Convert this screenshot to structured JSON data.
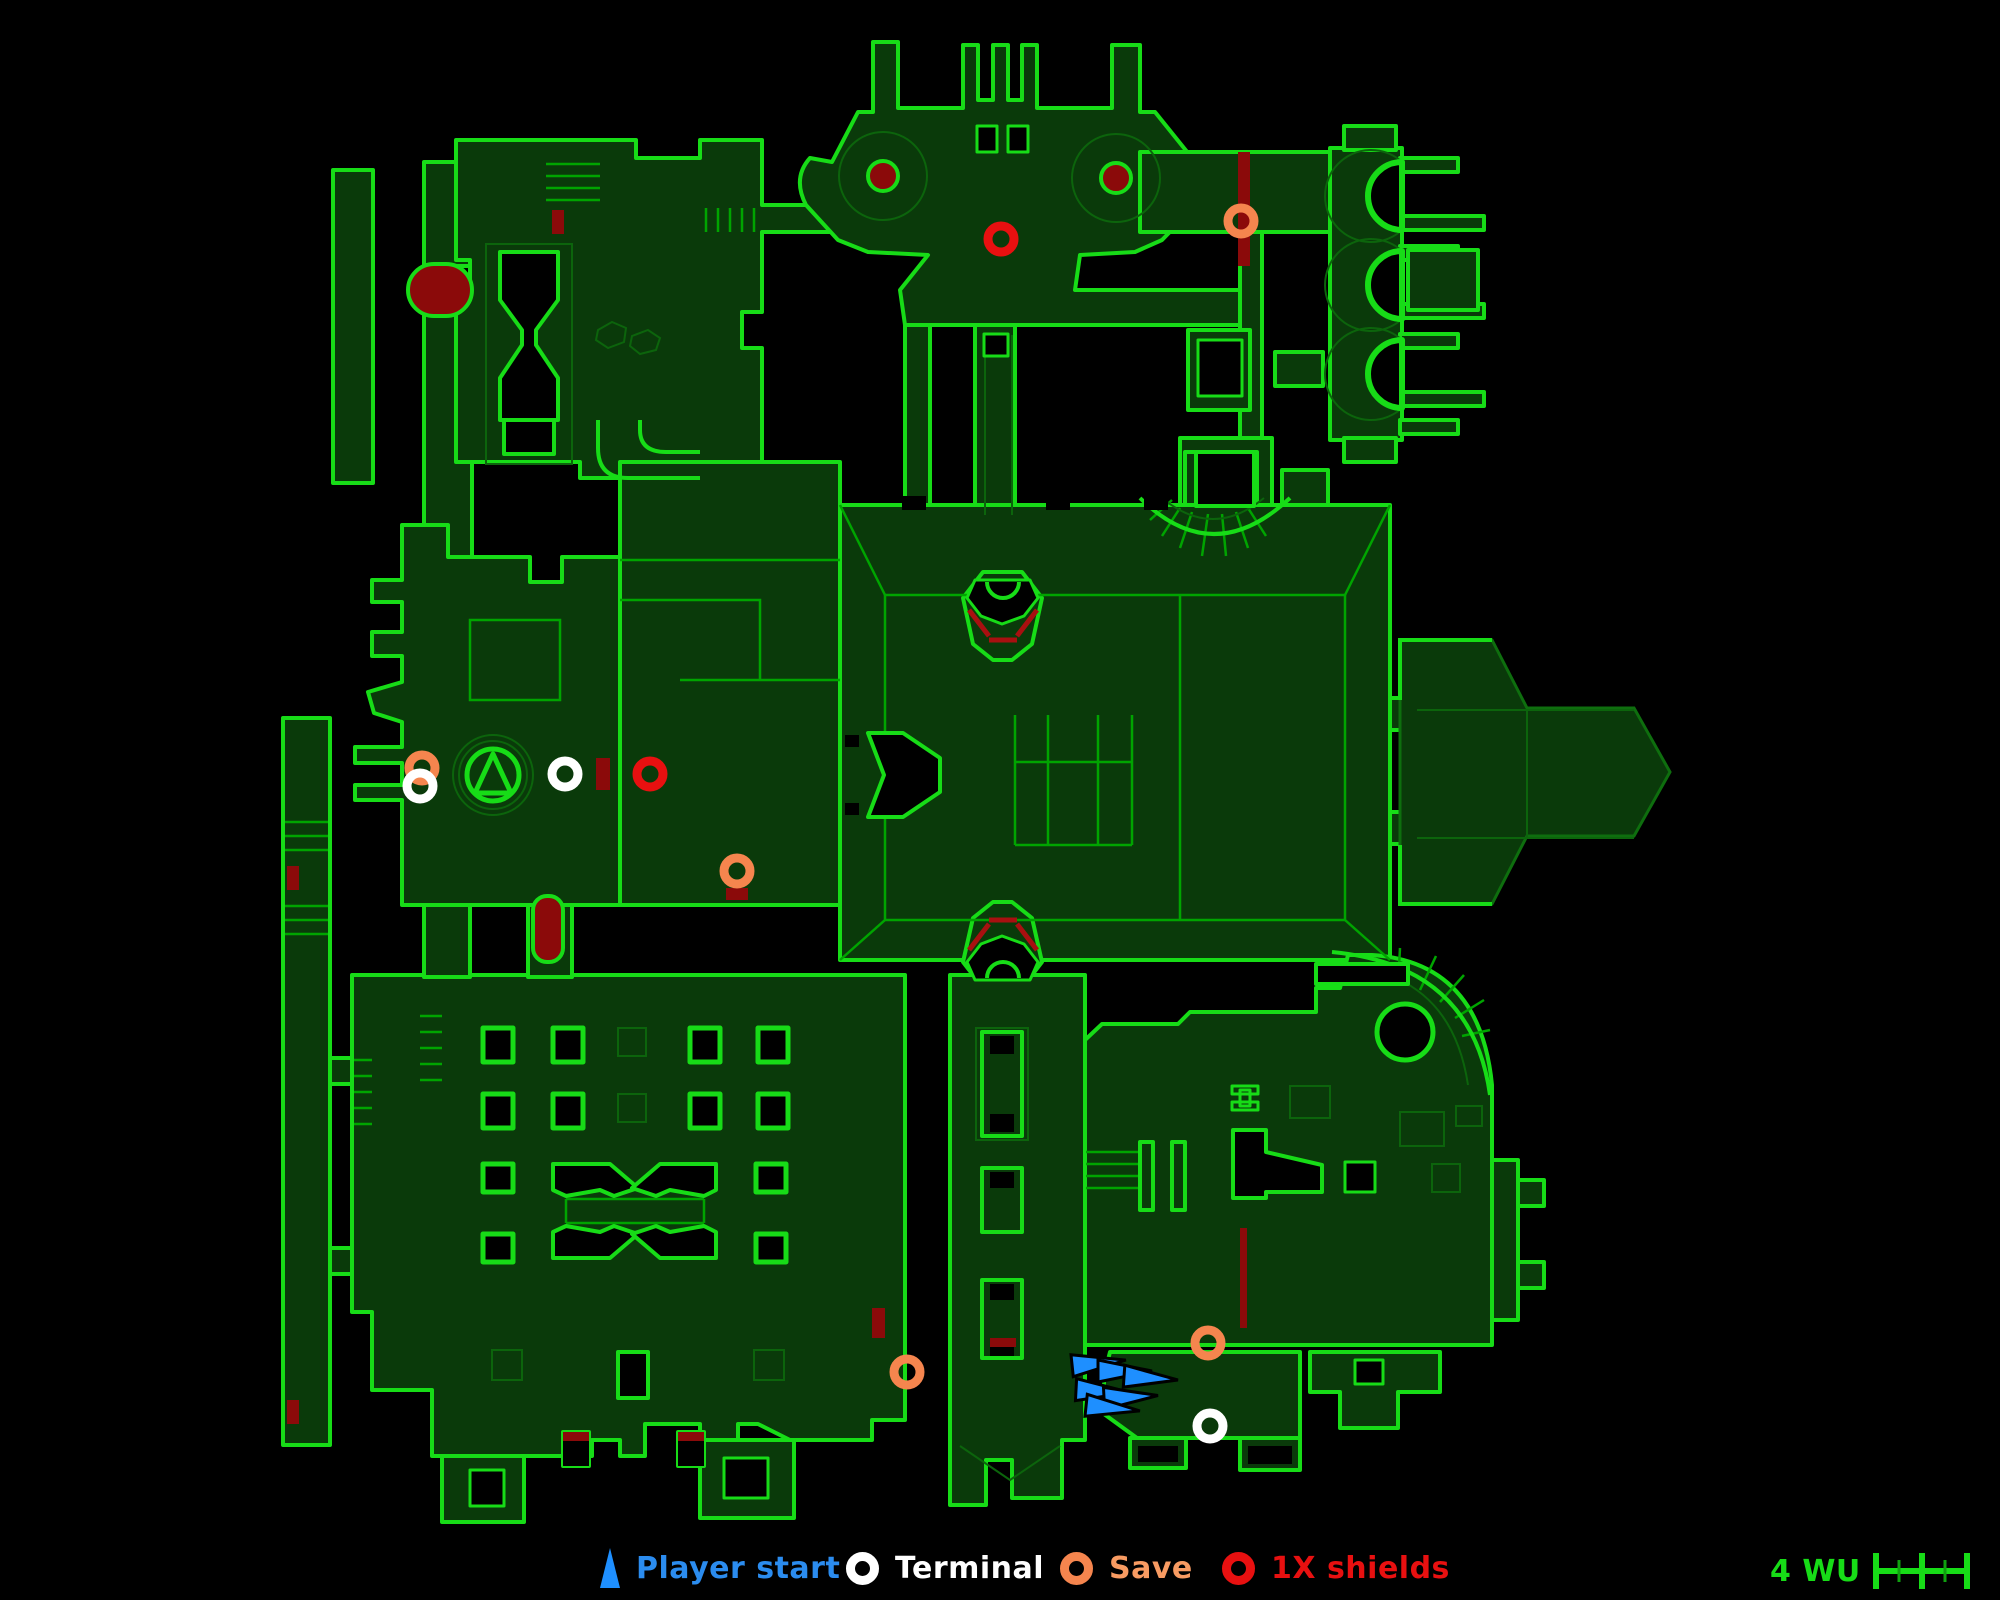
{
  "legend": {
    "items": [
      {
        "id": "player-start",
        "label": "Player start",
        "marker": "triangle",
        "color": "#1E8FFF"
      },
      {
        "id": "terminal",
        "label": "Terminal",
        "marker": "ring",
        "color": "#FFFFFF"
      },
      {
        "id": "save",
        "label": "Save",
        "marker": "ring",
        "color": "#F5854E"
      },
      {
        "id": "shields",
        "label": "1X shields",
        "marker": "ring",
        "color": "#E81010"
      }
    ],
    "scale": {
      "label": "4 WU",
      "units": 4,
      "color": "#17DC17"
    }
  },
  "map": {
    "background": "#000000",
    "wall_fill": "#0A3A0A",
    "line_bright": "#17DC17",
    "line_mid": "#00A400",
    "line_dim": "#0C640C",
    "hazard_red": "#8B0A0A",
    "markers": {
      "player_starts": [
        {
          "x": 1098,
          "y": 1363,
          "angle": -6
        },
        {
          "x": 1124,
          "y": 1371,
          "angle": 0
        },
        {
          "x": 1150,
          "y": 1378,
          "angle": 4
        },
        {
          "x": 1102,
          "y": 1391,
          "angle": 3
        },
        {
          "x": 1130,
          "y": 1397,
          "angle": -3
        },
        {
          "x": 1112,
          "y": 1408,
          "angle": 6
        }
      ],
      "terminals": [
        {
          "x": 420,
          "y": 786
        },
        {
          "x": 565,
          "y": 774
        },
        {
          "x": 1210,
          "y": 1426
        }
      ],
      "saves": [
        {
          "x": 422,
          "y": 768
        },
        {
          "x": 1241,
          "y": 221
        },
        {
          "x": 737,
          "y": 871
        },
        {
          "x": 907,
          "y": 1372
        },
        {
          "x": 1208,
          "y": 1343
        }
      ],
      "shields": [
        {
          "x": 1001,
          "y": 239
        },
        {
          "x": 650,
          "y": 774
        }
      ]
    }
  }
}
